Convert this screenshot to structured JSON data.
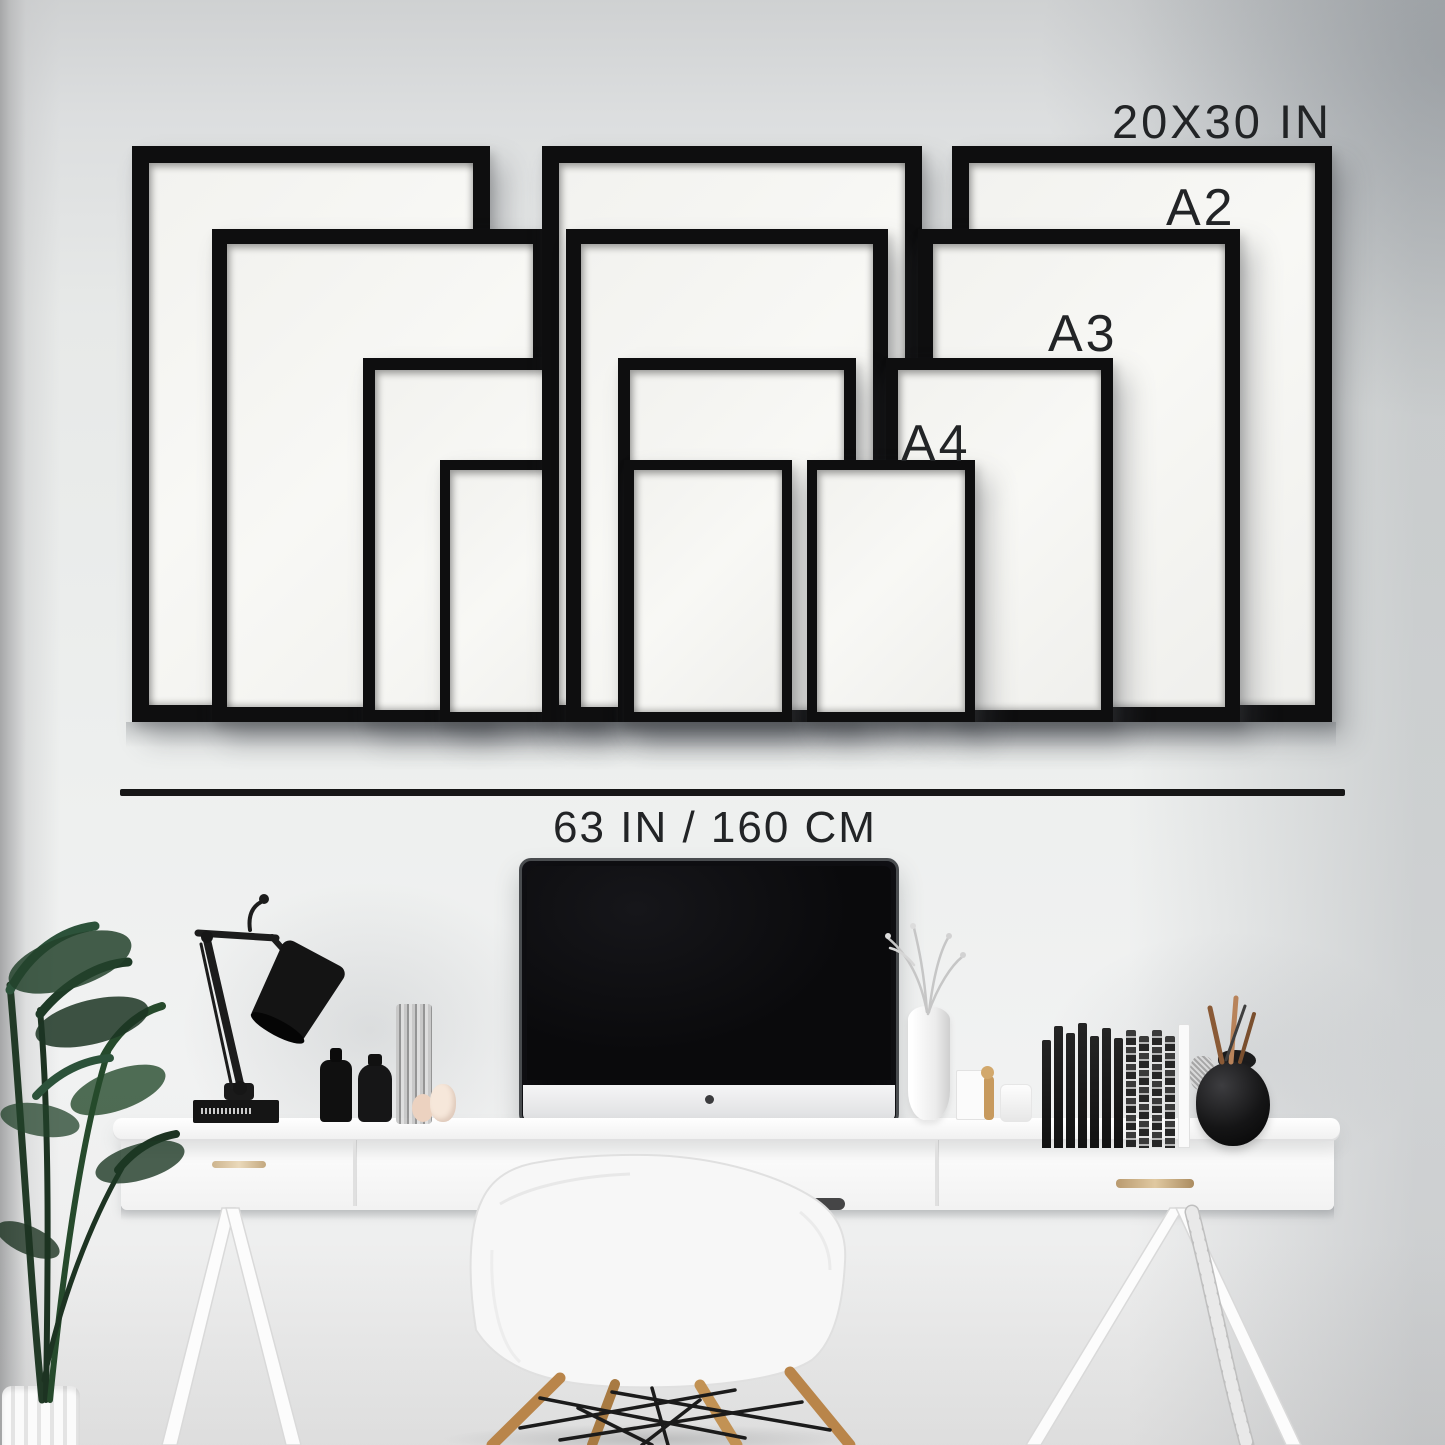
{
  "labels": {
    "size_20x30": "20X30 IN",
    "size_a2": "A2",
    "size_a3": "A3",
    "size_a4": "A4",
    "wall_width": "63 IN / 160 CM"
  },
  "frames": {
    "frame_color": "#0e0e0f",
    "mat_color": "#f5f5f2",
    "sizes_shown": [
      "20x30 in",
      "A2",
      "A3",
      "A4"
    ],
    "clusters": [
      "left",
      "center",
      "right"
    ],
    "items": [
      {
        "cluster": "left",
        "size": "20x30",
        "x": 132,
        "y": 146,
        "w": 358,
        "h": 576,
        "border": 17,
        "z": 1
      },
      {
        "cluster": "left",
        "size": "a2",
        "x": 212,
        "y": 229,
        "w": 336,
        "h": 493,
        "border": 15,
        "z": 2
      },
      {
        "cluster": "left",
        "size": "a3",
        "x": 363,
        "y": 358,
        "w": 234,
        "h": 364,
        "border": 12,
        "z": 3
      },
      {
        "cluster": "left",
        "size": "a4",
        "x": 440,
        "y": 460,
        "w": 168,
        "h": 262,
        "border": 10,
        "z": 4
      },
      {
        "cluster": "center",
        "size": "20x30",
        "x": 542,
        "y": 146,
        "w": 380,
        "h": 576,
        "border": 17,
        "z": 5
      },
      {
        "cluster": "center",
        "size": "a2",
        "x": 566,
        "y": 229,
        "w": 322,
        "h": 493,
        "border": 15,
        "z": 6
      },
      {
        "cluster": "center",
        "size": "a3",
        "x": 618,
        "y": 358,
        "w": 238,
        "h": 364,
        "border": 12,
        "z": 7
      },
      {
        "cluster": "center",
        "size": "a4",
        "x": 624,
        "y": 460,
        "w": 168,
        "h": 262,
        "border": 10,
        "z": 8
      },
      {
        "cluster": "right",
        "size": "20x30",
        "x": 952,
        "y": 146,
        "w": 380,
        "h": 576,
        "border": 17,
        "z": 9
      },
      {
        "cluster": "right",
        "size": "a2",
        "x": 918,
        "y": 229,
        "w": 322,
        "h": 493,
        "border": 15,
        "z": 10
      },
      {
        "cluster": "right",
        "size": "a3",
        "x": 886,
        "y": 358,
        "w": 227,
        "h": 364,
        "border": 12,
        "z": 11
      },
      {
        "cluster": "right",
        "size": "a4",
        "x": 807,
        "y": 460,
        "w": 168,
        "h": 262,
        "border": 10,
        "z": 12
      }
    ]
  },
  "measure": {
    "label": "63 IN / 160 CM",
    "x1": 120,
    "x2": 1345,
    "y": 789
  },
  "books": {
    "black": 7,
    "striped": 4
  },
  "colors": {
    "wall": "#e9ebea",
    "wall_shade": "#c9cbcd",
    "frame": "#0e0e0f",
    "text": "#222426",
    "desk": "#f7f7f7",
    "handle_brass": "#cdb48e",
    "plant_green": "#24402a",
    "chair_white": "#f7f7f7",
    "wood_leg": "#b9854a",
    "screen_black": "#0b0b0d"
  },
  "decor_items": [
    "desk-lamp",
    "imac-computer",
    "eames-style-chair",
    "white-desk-with-drawers",
    "potted-plant",
    "white-sculptural-vase-with-branches",
    "black-book",
    "black-bottles",
    "textured-glass-vase",
    "stone-pebbles",
    "white-card",
    "wooden-mannequin",
    "white-jar",
    "book-spines-row",
    "brush-pot-with-sticks",
    "white-ribbed-planter"
  ]
}
